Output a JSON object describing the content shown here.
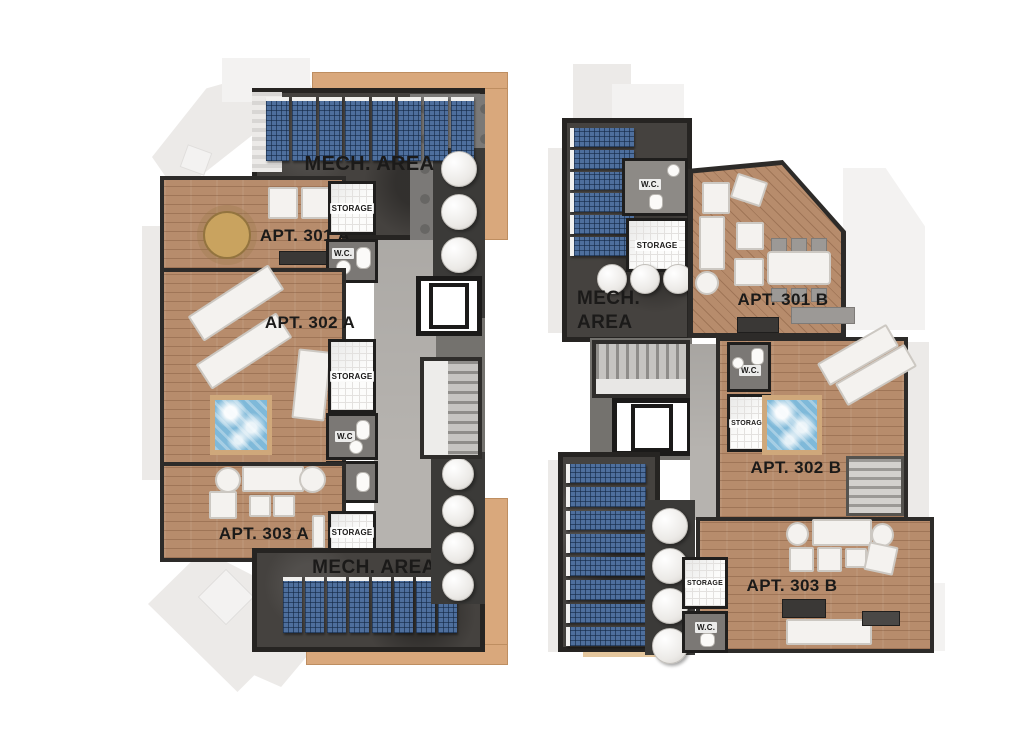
{
  "colors": {
    "background": "#ffffff",
    "wood_deck": "#d9a87c",
    "apartment_floor": "#b78c6c",
    "wall": "#2d2b29",
    "mech_area": "#45423f",
    "corridor": "#b6b3af",
    "solar_panel": "#4e6f9d",
    "solar_panel_grid": "#24456e",
    "water_tank": "#f2f0ed",
    "hot_tub_water": "#7fb9d9",
    "ghost_outline": "#eceae8"
  },
  "plan_a": {
    "mech_top_label": "MECH. AREA",
    "mech_bottom_label": "MECH. AREA",
    "apartments": [
      {
        "label": "APT. 301 A"
      },
      {
        "label": "APT. 302 A"
      },
      {
        "label": "APT. 303 A"
      }
    ],
    "storage_labels": [
      "STORAGE",
      "STORAGE",
      "STORAGE"
    ],
    "wc_labels": [
      "W.C.",
      "W.C"
    ],
    "solar_panels": {
      "top_row": 8,
      "bottom_row": 8
    },
    "water_tanks": {
      "upper_column": 4,
      "lower_column": 4
    }
  },
  "plan_b": {
    "mech_label_line1": "MECH.",
    "mech_label_line2": "AREA",
    "apartments": [
      {
        "label": "APT. 301 B"
      },
      {
        "label": "APT. 302 B"
      },
      {
        "label": "APT. 303 B"
      }
    ],
    "storage_labels": [
      "STORAGE",
      "STORAGE",
      "STORAGE"
    ],
    "wc_labels": [
      "W.C.",
      "W.C.",
      "W.C."
    ],
    "solar_panels": {
      "top_column": 6,
      "bottom_column": 8
    },
    "water_tanks": {
      "upper_row": 3,
      "lower_column": 4
    }
  }
}
